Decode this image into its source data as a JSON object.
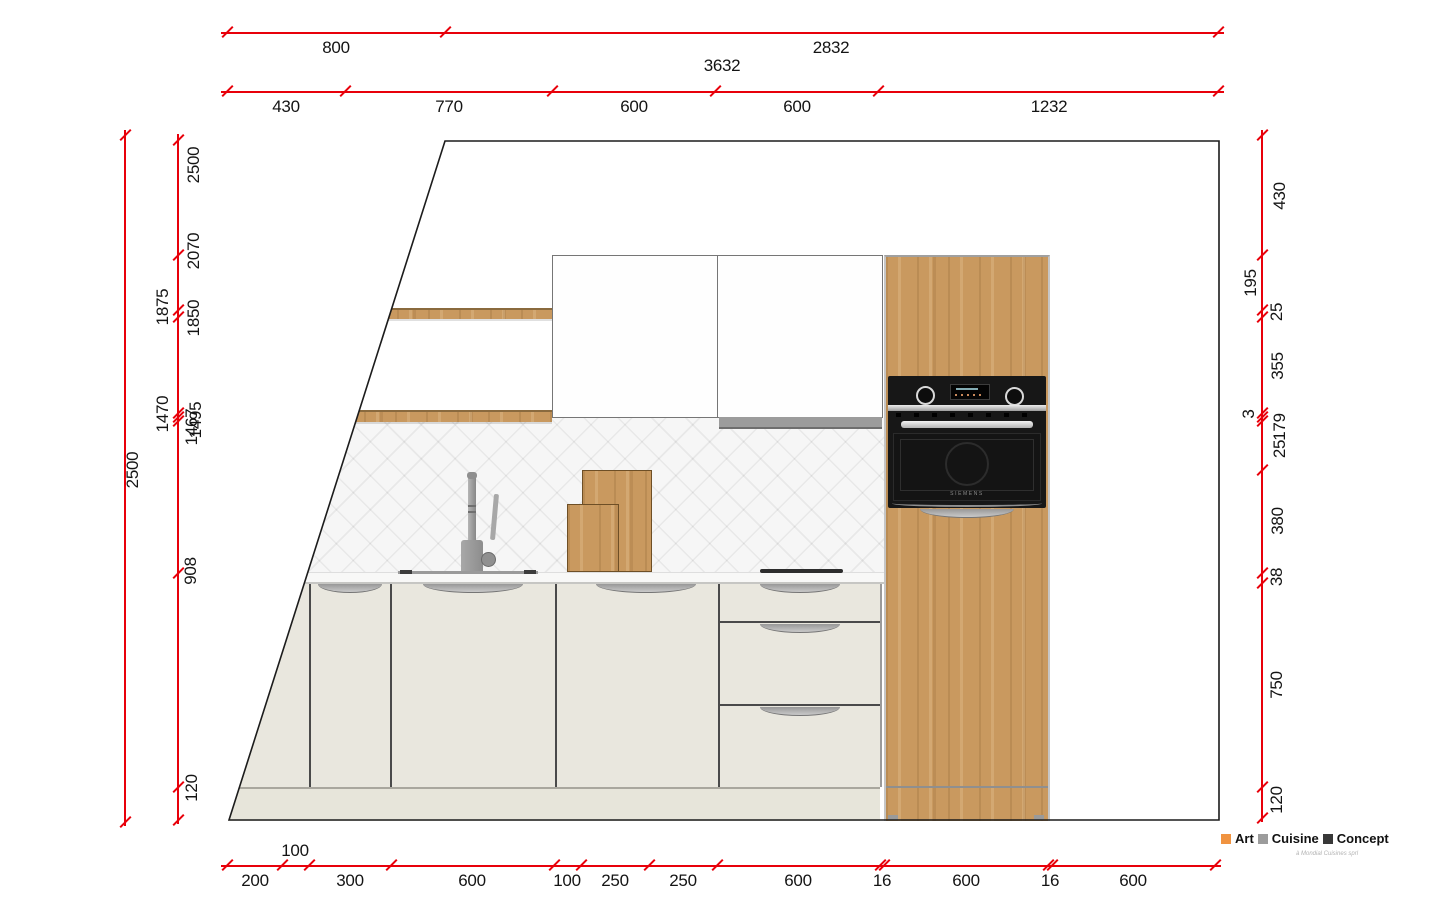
{
  "drawing": {
    "kind": "kitchen elevation with dimensions",
    "colors": {
      "dimension_red": "#e8000a",
      "wood_oak": "#c9995f",
      "cabinet_cream": "#e9e7de",
      "oven_black": "#171717",
      "tile_grey": "#f6f6f6"
    }
  },
  "dims": {
    "top_row1": [
      "800",
      "2832"
    ],
    "top_total": "3632",
    "top_row2": [
      "430",
      "770",
      "600",
      "600",
      "1232"
    ],
    "bottom": [
      "200",
      "100",
      "300",
      "600",
      "100",
      "250",
      "250",
      "600",
      "16",
      "600",
      "16",
      "600"
    ],
    "left_outer": "2500",
    "left": [
      "2500",
      "2070",
      "1875",
      "1850",
      "1470",
      "1495",
      "1467",
      "908",
      "120"
    ],
    "right": [
      "430",
      "195",
      "25",
      "355",
      "3",
      "179",
      "25",
      "380",
      "38",
      "750",
      "120"
    ]
  },
  "appliances": {
    "oven_brand": "SIEMENS"
  },
  "logo": {
    "word1": "Art",
    "word2": "Cuisine",
    "word3": "Concept",
    "tagline": "à Mondial Cuisines sprl",
    "color1": "#f09340",
    "color2": "#9c9c9c",
    "color3": "#383838"
  }
}
